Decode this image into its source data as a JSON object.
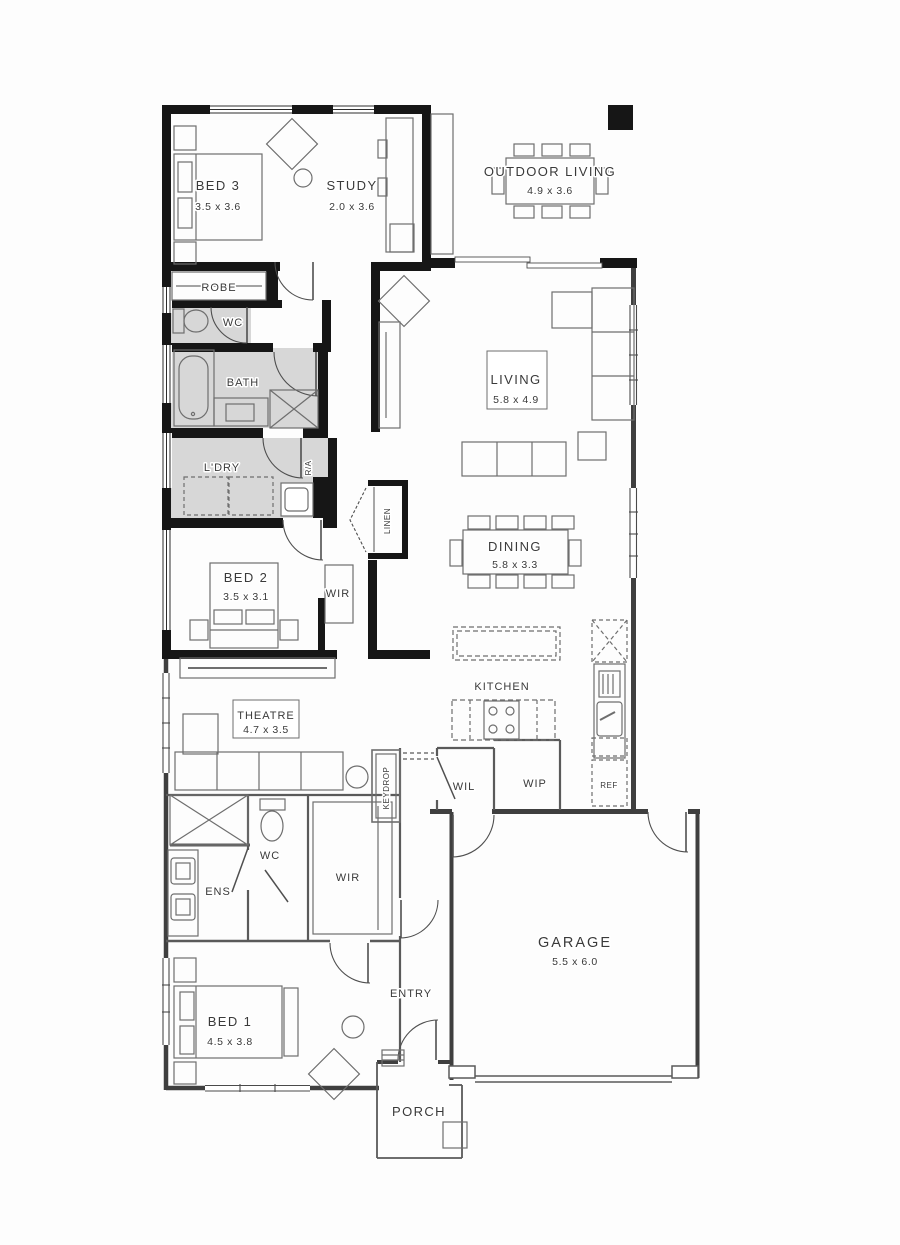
{
  "plan": {
    "title": "Single storey home floor plan",
    "rooms": {
      "bed3": {
        "name": "BED 3",
        "dims": "3.5 x 3.6"
      },
      "study": {
        "name": "STUDY",
        "dims": "2.0 x 3.6"
      },
      "outdoor": {
        "name": "OUTDOOR LIVING",
        "dims": "4.9 x 3.6"
      },
      "robe": {
        "name": "ROBE"
      },
      "wc_main": {
        "name": "WC"
      },
      "bath": {
        "name": "BATH"
      },
      "ldry": {
        "name": "L'DRY"
      },
      "ra": {
        "name": "R/A"
      },
      "linen": {
        "name": "LINEN"
      },
      "bed2": {
        "name": "BED 2",
        "dims": "3.5 x 3.1"
      },
      "wir_bed2": {
        "name": "WIR"
      },
      "living": {
        "name": "LIVING",
        "dims": "5.8 x 4.9"
      },
      "dining": {
        "name": "DINING",
        "dims": "5.8 x 3.3"
      },
      "kitchen": {
        "name": "KITCHEN"
      },
      "theatre": {
        "name": "THEATRE",
        "dims": "4.7 x 3.5"
      },
      "keydrop": {
        "name": "KEYDROP"
      },
      "wil": {
        "name": "WIL"
      },
      "wip": {
        "name": "WIP"
      },
      "ref": {
        "name": "REF"
      },
      "wc_ens": {
        "name": "WC"
      },
      "ens": {
        "name": "ENS"
      },
      "wir_bed1": {
        "name": "WIR"
      },
      "bed1": {
        "name": "BED 1",
        "dims": "4.5 x 3.8"
      },
      "entry": {
        "name": "ENTRY"
      },
      "garage": {
        "name": "GARAGE",
        "dims": "5.5 x 6.0"
      },
      "porch": {
        "name": "PORCH"
      }
    },
    "colors": {
      "wall": "#161616",
      "thin_wall": "#3f3f3f",
      "interior_wall": "#5a5a5a",
      "wet_area_fill": "#d7d7d7",
      "furniture": "#6e6e6e",
      "text": "#3a3a3a",
      "background": "#fdfdfd"
    }
  }
}
